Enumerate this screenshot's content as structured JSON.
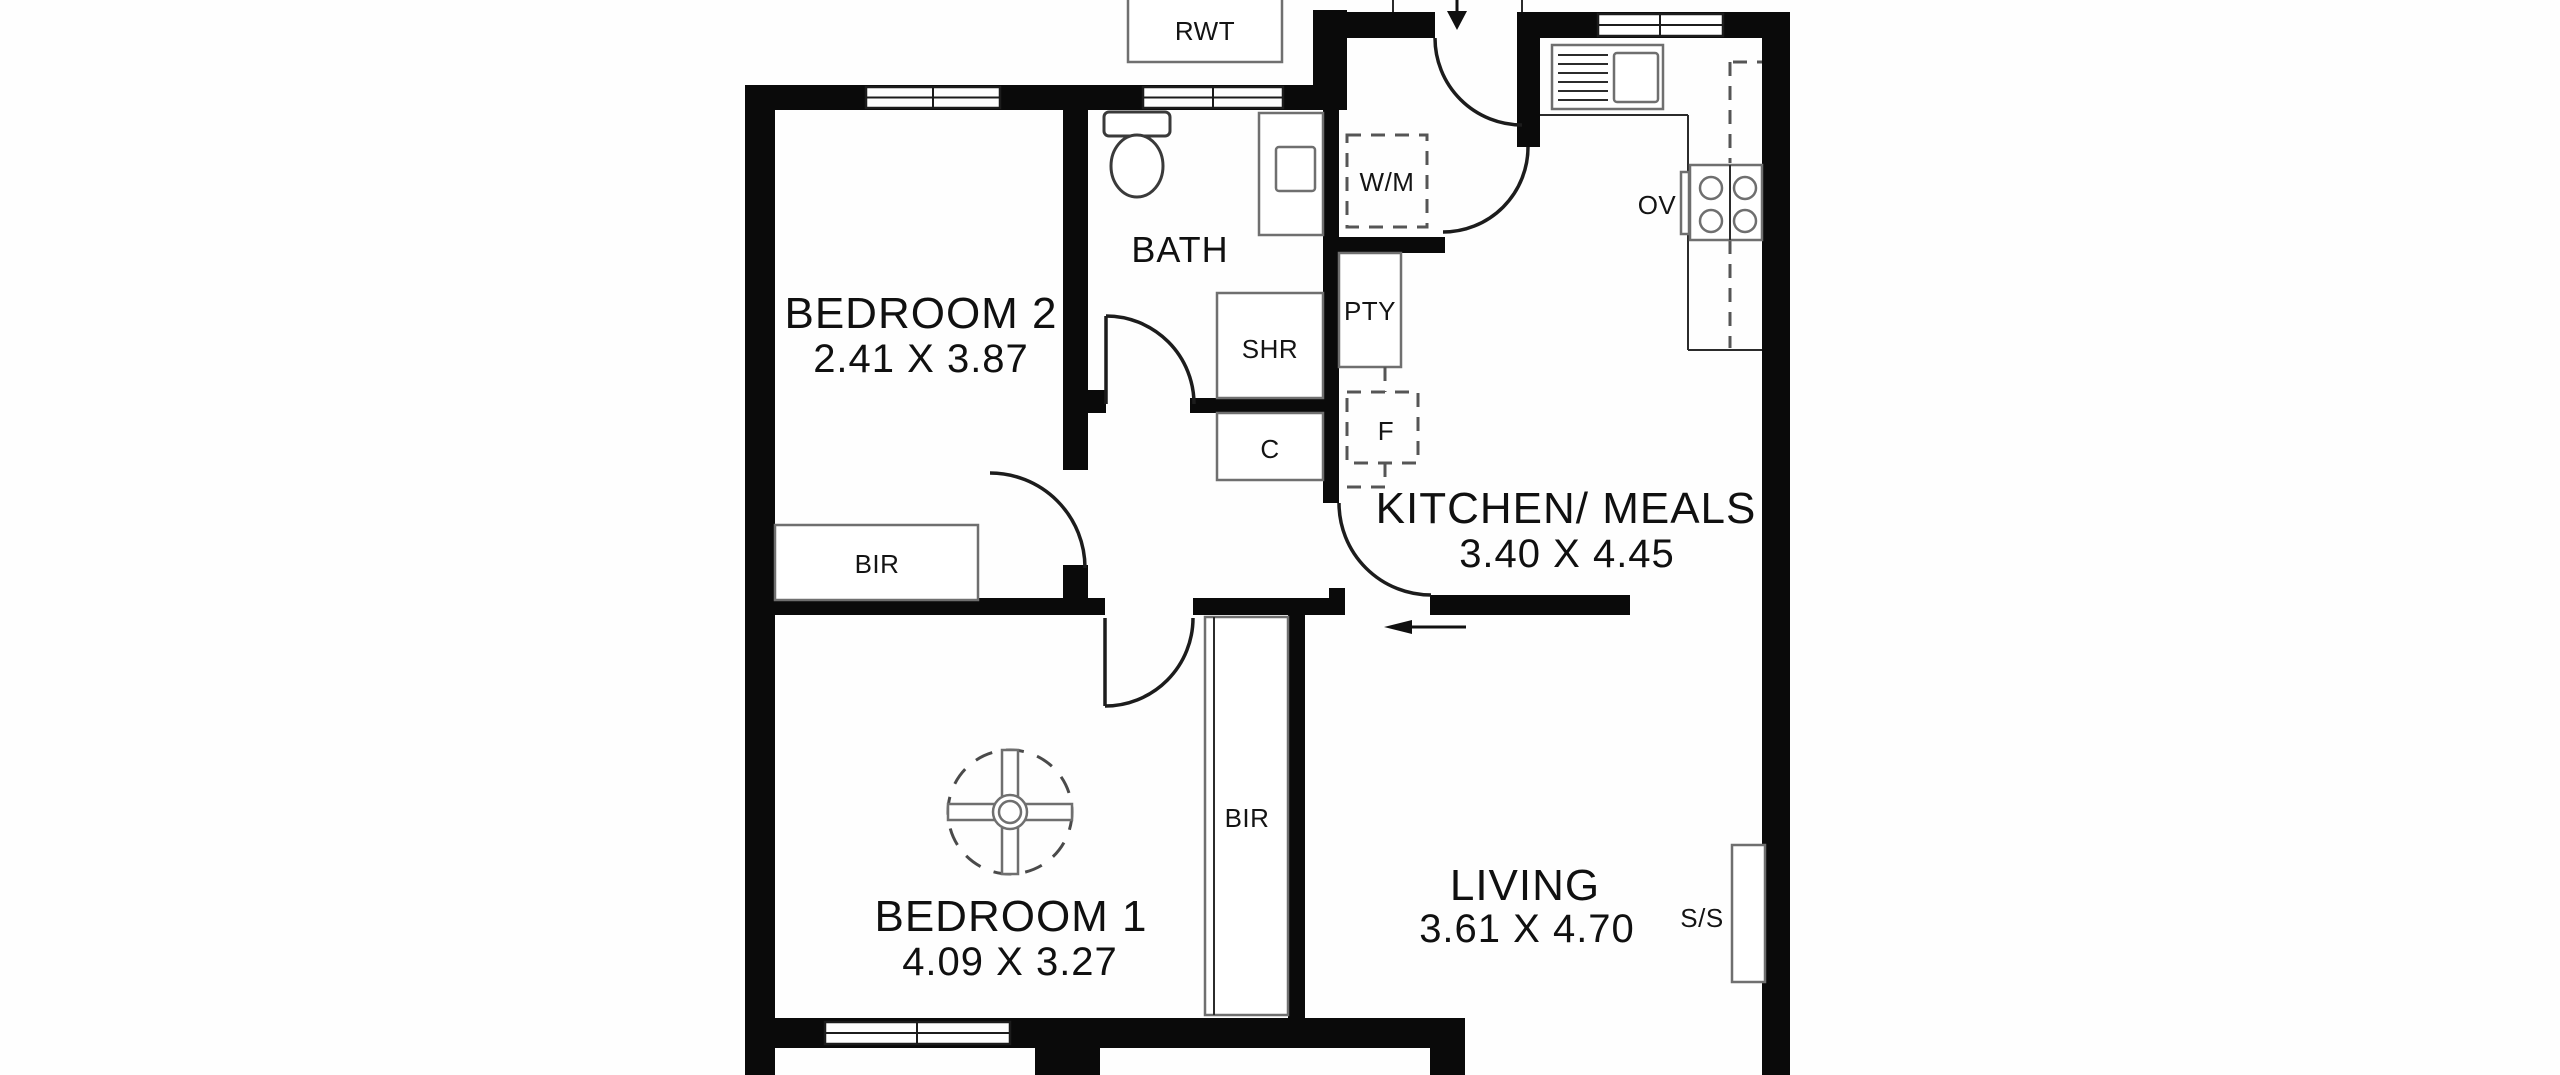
{
  "canvas": {
    "width": 2560,
    "height": 1075,
    "background": "#ffffff",
    "wall_color": "#0a0a0a"
  },
  "rooms": {
    "bedroom2": {
      "name": "BEDROOM 2",
      "dims": "2.41 X 3.87"
    },
    "bath": {
      "name": "BATH"
    },
    "kitchen_meals": {
      "name": "KITCHEN/ MEALS",
      "dims": "3.40 X 4.45"
    },
    "bedroom1": {
      "name": "BEDROOM 1",
      "dims": "4.09 X 3.27"
    },
    "living": {
      "name": "LIVING",
      "dims": "3.61 X 4.70"
    }
  },
  "fixtures": {
    "rainwater_tank": "RWT",
    "washing_machine": "W/M",
    "pantry": "PTY",
    "shower": "SHR",
    "cupboard": "C",
    "fridge": "F",
    "oven": "OV",
    "robe_bedroom2": "BIR",
    "robe_bedroom1": "BIR",
    "stainless_sink": "S/S"
  }
}
